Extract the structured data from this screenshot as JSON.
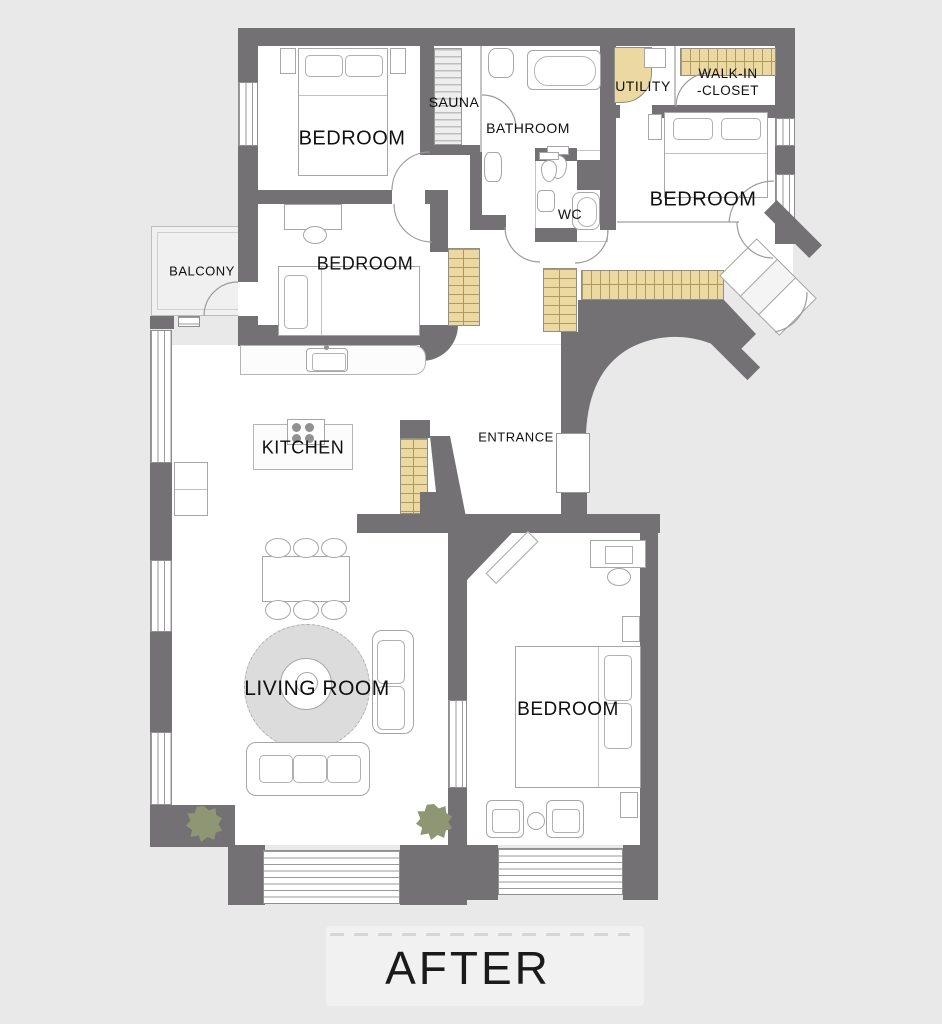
{
  "image_type": "apartment floor plan",
  "caption": "AFTER",
  "rooms": {
    "bedroom_top_left": {
      "label": "BEDROOM"
    },
    "sauna": {
      "label": "SAUNA"
    },
    "bathroom": {
      "label": "BATHROOM"
    },
    "utility": {
      "label": "UTILITY"
    },
    "walk_in_closet": {
      "label_line_1": "WALK-IN",
      "label_line_2": "-CLOSET"
    },
    "bedroom_right": {
      "label": "BEDROOM"
    },
    "wc": {
      "label": "WC"
    },
    "balcony": {
      "label": "BALCONY"
    },
    "bedroom_middle": {
      "label": "BEDROOM"
    },
    "kitchen": {
      "label": "KITCHEN"
    },
    "entrance": {
      "label": "ENTRANCE"
    },
    "living_room": {
      "label": "LIVING ROOM"
    },
    "bedroom_bottom_right": {
      "label": "BEDROOM"
    }
  },
  "colors": {
    "background": "#e9e9e9",
    "wall": "#737174",
    "floor": "#ffffff",
    "balcony_floor": "#f0f0f0",
    "wardrobe_fill": "#ecd9a1",
    "plant": "#8f9674",
    "rug": "#dcdcdc",
    "label_text": "#101010"
  }
}
